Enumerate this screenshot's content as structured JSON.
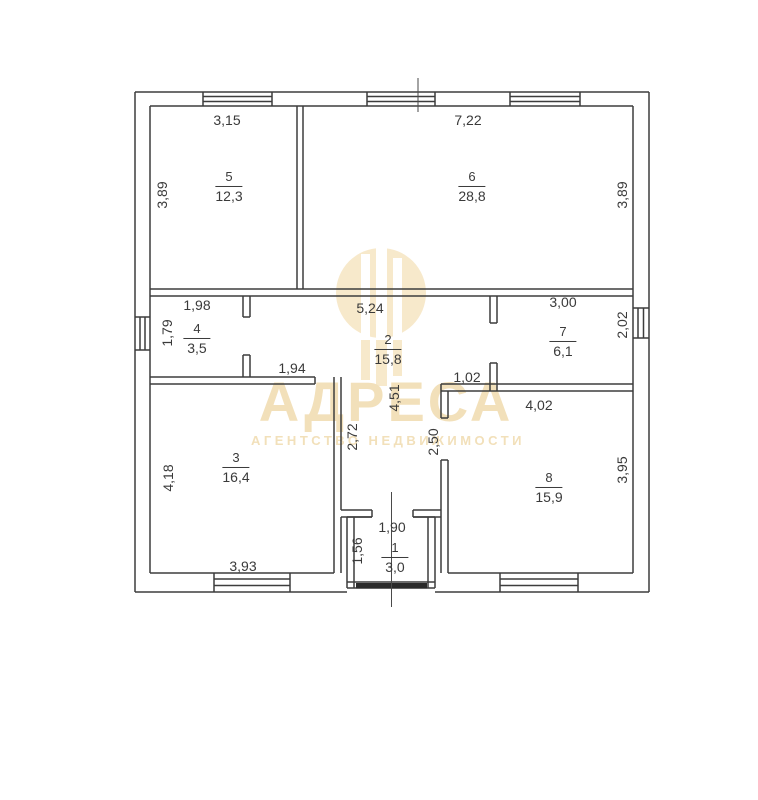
{
  "watermark": {
    "brand": "АДРЕСА",
    "tagline": "АГЕНТСТВО НЕДВИЖИМОСТИ",
    "color": "#f2e0ba"
  },
  "plan": {
    "line_color": "#3d3d3d",
    "door_color": "#2b2b2b",
    "rooms": {
      "r1": {
        "number": "1",
        "area": "3,0"
      },
      "r2": {
        "number": "2",
        "area": "15,8"
      },
      "r3": {
        "number": "3",
        "area": "16,4"
      },
      "r4": {
        "number": "4",
        "area": "3,5"
      },
      "r5": {
        "number": "5",
        "area": "12,3"
      },
      "r6": {
        "number": "6",
        "area": "28,8"
      },
      "r7": {
        "number": "7",
        "area": "6,1"
      },
      "r8": {
        "number": "8",
        "area": "15,9"
      }
    },
    "dims": {
      "room5_width": "3,15",
      "room5_height": "3,89",
      "room6_width": "7,22",
      "room6_height": "3,89",
      "room4_width": "1,98",
      "room4_height": "1,79",
      "room2_width": "5,24",
      "room7_width": "3,00",
      "room7_height": "2,02",
      "hall_width": "1,94",
      "hall_length": "4,51",
      "hall_left": "2,72",
      "hall_right": "2,50",
      "wall_gap": "1,02",
      "room3_width": "3,93",
      "room3_height": "4,18",
      "room8_width": "4,02",
      "room8_height": "3,95",
      "room1_width": "1,90",
      "room1_height": "1,56"
    }
  }
}
